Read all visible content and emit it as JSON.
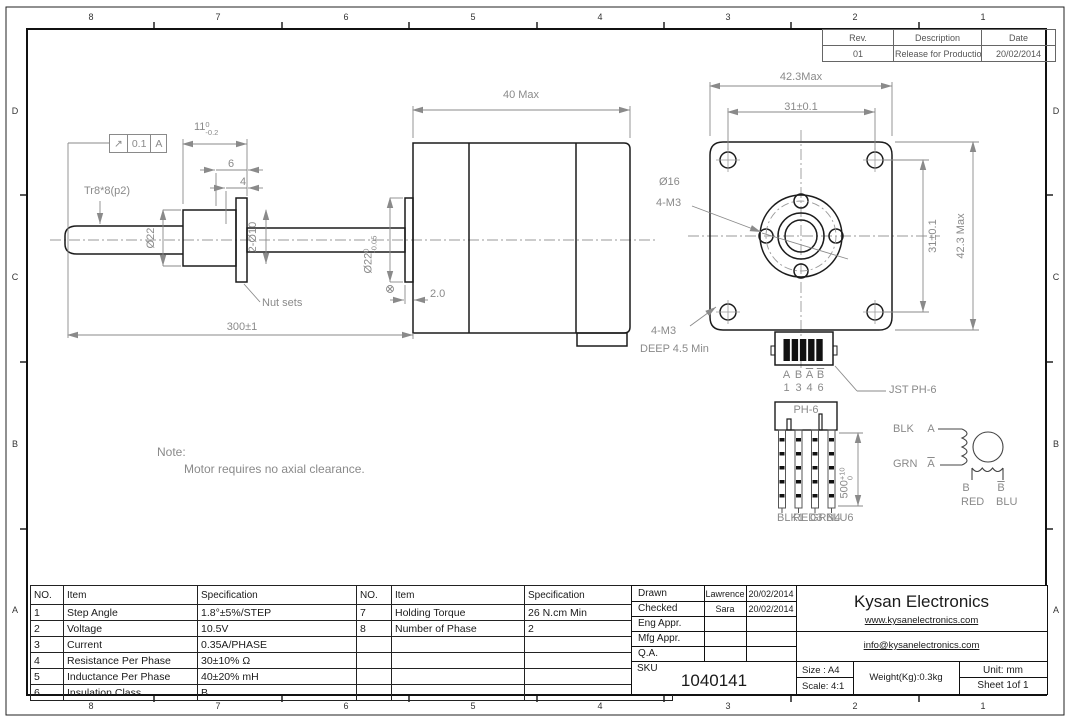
{
  "zones": {
    "top": [
      "8",
      "7",
      "6",
      "5",
      "4",
      "3",
      "2",
      "1"
    ],
    "bottom": [
      "8",
      "7",
      "6",
      "5",
      "4",
      "3",
      "2",
      "1"
    ],
    "left": [
      "D",
      "C",
      "B",
      "A"
    ],
    "right": [
      "D",
      "C",
      "B",
      "A"
    ]
  },
  "rev_table": {
    "col_rev": "Rev.",
    "col_desc": "Description",
    "col_date": "Date",
    "rev": "01",
    "desc": "Release for Production",
    "date": "20/02/2014"
  },
  "side_view": {
    "dim_40": "40 Max",
    "gdt_symbol": "↗",
    "gdt_tol": "0.1",
    "gdt_datum": "A",
    "dim_11": "11",
    "dim_11_sup": "0",
    "dim_11_sub": "-0.2",
    "dim_6": "6",
    "dim_4": "4",
    "thread": "Tr8*8(p2)",
    "dia22": "Ø22",
    "dia2x10": "2-Ø10",
    "dia22t": "Ø22",
    "dia22t_sup": "0",
    "dia22t_sub": "-0.05",
    "nut_sets": "Nut sets",
    "dim_2": "2.0",
    "dim_300": "300±1"
  },
  "front_view": {
    "dim_423_top": "42.3Max",
    "dim_31_top": "31±0.1",
    "dia16": "Ø16",
    "m3": "4-M3",
    "dim_31_right": "31±0.1",
    "dim_423_right": "42.3 Max",
    "m3_deep_l1": "4-M3",
    "m3_deep_l2": "DEEP 4.5 Min"
  },
  "connector": {
    "jst": "JST PH-6",
    "ph6": "PH-6",
    "pin_letters": {
      "a": "A",
      "b": "B",
      "abar": "A",
      "bbar": "B"
    },
    "pin_numbers": {
      "n1": "1",
      "n2": "3",
      "n3": "4",
      "n4": "6"
    },
    "dim_500": "500",
    "dim_500_sup": "+10",
    "dim_500_sub": "0",
    "wires": {
      "w1": "BLK1",
      "w2": "RED3",
      "w3": "GRN4",
      "w4": "BLU6"
    }
  },
  "schematic": {
    "blk": "BLK",
    "a": "A",
    "grn": "GRN",
    "abar": "A",
    "b": "B",
    "bbar": "B",
    "red": "RED",
    "blu": "BLU"
  },
  "note": {
    "title": "Note:",
    "body": "Motor requires no axial clearance."
  },
  "spec_table": {
    "headers": {
      "no": "NO.",
      "item": "Item",
      "spec": "Specification"
    },
    "left_rows": [
      {
        "no": "1",
        "item": "Step Angle",
        "spec": "1.8°±5%/STEP"
      },
      {
        "no": "2",
        "item": "Voltage",
        "spec": "10.5V"
      },
      {
        "no": "3",
        "item": "Current",
        "spec": "0.35A/PHASE"
      },
      {
        "no": "4",
        "item": "Resistance Per Phase",
        "spec": "30±10% Ω"
      },
      {
        "no": "5",
        "item": "Inductance Per Phase",
        "spec": "40±20% mH"
      },
      {
        "no": "6",
        "item": "Insulation Class",
        "spec": "B"
      }
    ],
    "right_rows": [
      {
        "no": "7",
        "item": "Holding Torque",
        "spec": "26 N.cm Min"
      },
      {
        "no": "8",
        "item": "Number of Phase",
        "spec": "2"
      },
      {
        "no": "",
        "item": "",
        "spec": ""
      },
      {
        "no": "",
        "item": "",
        "spec": ""
      },
      {
        "no": "",
        "item": "",
        "spec": ""
      },
      {
        "no": "",
        "item": "",
        "spec": ""
      }
    ]
  },
  "title_block": {
    "drawn_label": "Drawn",
    "drawn_name": "Lawrence",
    "drawn_date": "20/02/2014",
    "checked_label": "Checked",
    "checked_name": "Sara",
    "checked_date": "20/02/2014",
    "eng_label": "Eng Appr.",
    "mfg_label": "Mfg Appr.",
    "qa_label": "Q.A.",
    "sku_label": "SKU",
    "sku": "1040141",
    "company": "Kysan Electronics",
    "website": "www.kysanelectronics.com",
    "email": "info@kysanelectronics.com",
    "size": "Size : A4",
    "scale": "Scale: 4:1",
    "weight": "Weight(Kg):0.3kg",
    "unit": "Unit: mm",
    "sheet": "Sheet 1of 1"
  }
}
